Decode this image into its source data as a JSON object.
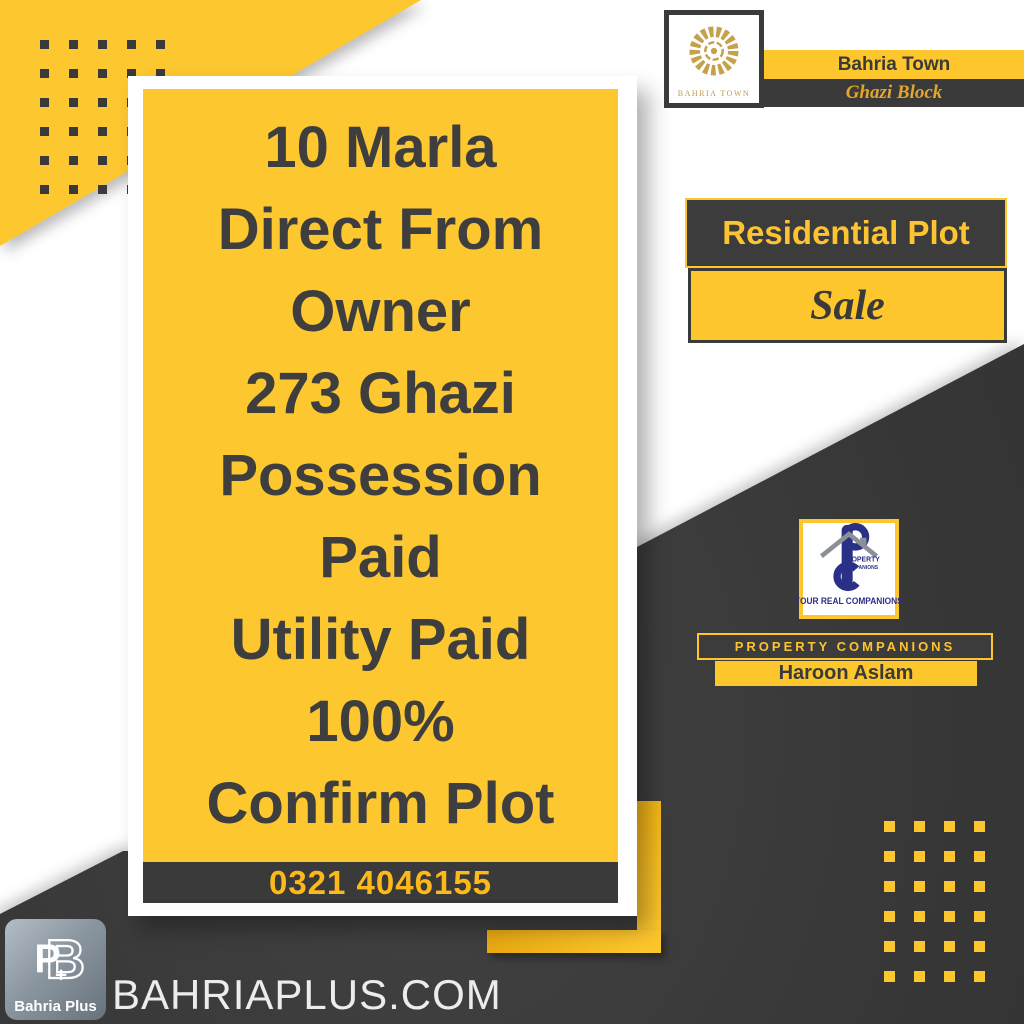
{
  "colors": {
    "yellow": "#FDC62C",
    "dark": "#3A3A3A",
    "gold": "#BD9A4F",
    "navy": "#2B3087",
    "phone_yellow": "#FDB919"
  },
  "header": {
    "logo_caption": "BAHRIA TOWN",
    "town_title": "Bahria Town",
    "block_subtitle": "Ghazi Block"
  },
  "listing_card": {
    "lines": [
      "10 Marla",
      "Direct From",
      "Owner",
      "273 Ghazi",
      "Possession",
      "Paid",
      "Utility Paid",
      "100%",
      "Confirm Plot"
    ],
    "phone": "0321 4046155"
  },
  "property_badge": {
    "type": "Residential Plot",
    "status": "Sale"
  },
  "agent": {
    "logo_line1": "PROPERTY",
    "logo_line2": "COMPANIONS",
    "logo_tagline": "YOUR REAL COMPANIONS",
    "company_bar": "PROPERTY COMPANIONS",
    "name": "Haroon Aslam"
  },
  "footer": {
    "logo_caption": "Bahria Plus",
    "website": "BAHRIAPLUS.COM"
  },
  "decor": {
    "top_left_dots": {
      "rows": 6,
      "cols": 5
    },
    "bottom_right_dots": {
      "rows": 6,
      "cols": 4
    }
  }
}
